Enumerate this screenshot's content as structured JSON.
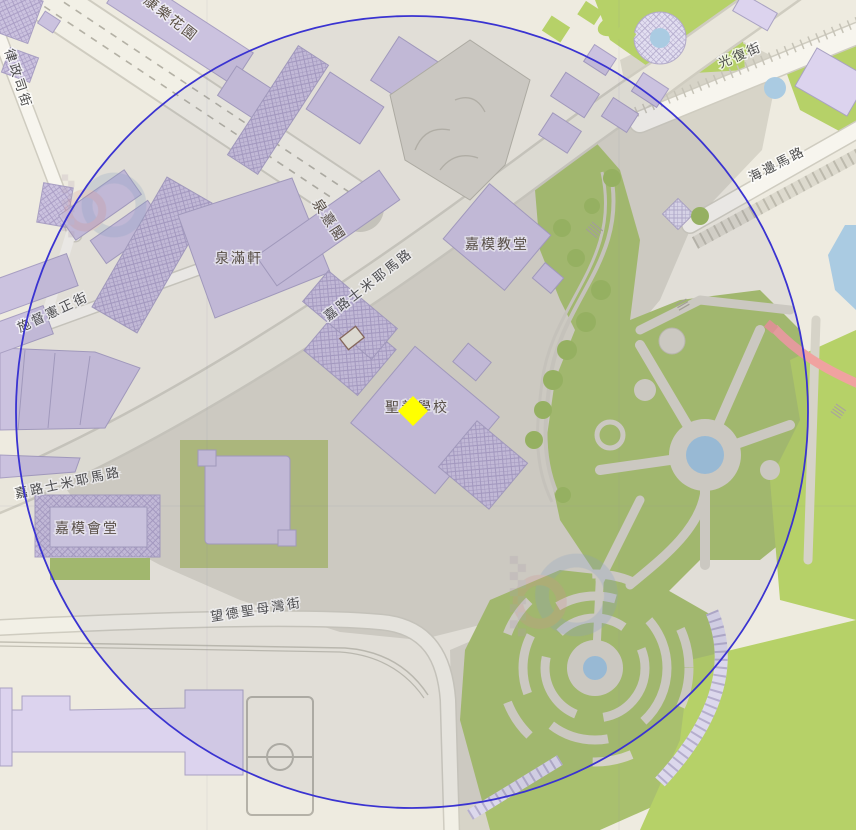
{
  "map": {
    "labels": {
      "hong_lok_garden": "康樂花園",
      "rua_da_justica": "律政司街",
      "chun_hei_court": "泉憙閣",
      "chun_mun_court": "泉滿軒",
      "carmel_church": "嘉模教堂",
      "carlos_da_maia_road_upper": "嘉路士米耶馬路",
      "governor_street": "施督憲正街",
      "sacred_heart_school": "聖善學校",
      "carlos_da_maia_road_lower": "嘉路士米耶馬路",
      "carmel_hall": "嘉模會堂",
      "nossa_senhora_bay_street": "望德聖母灣街",
      "kwong_fuk_street": "光復街",
      "seaside_road": "海邊馬路"
    }
  },
  "overlay": {
    "marker_color": "#ffff00",
    "circle_color": "#3a33d1",
    "circle_fill": "rgba(80,80,110,0.08)"
  },
  "palette": {
    "building": "#cbc2df",
    "building_light": "#dcd3ee",
    "park_green": "#a9c06e",
    "bright_green": "#b6d168",
    "water": "#aacbe2",
    "paved": "#d7d4c8",
    "road": "#f7f5ee",
    "red_path": "#f0a2a0",
    "land": "#eeebe0"
  }
}
